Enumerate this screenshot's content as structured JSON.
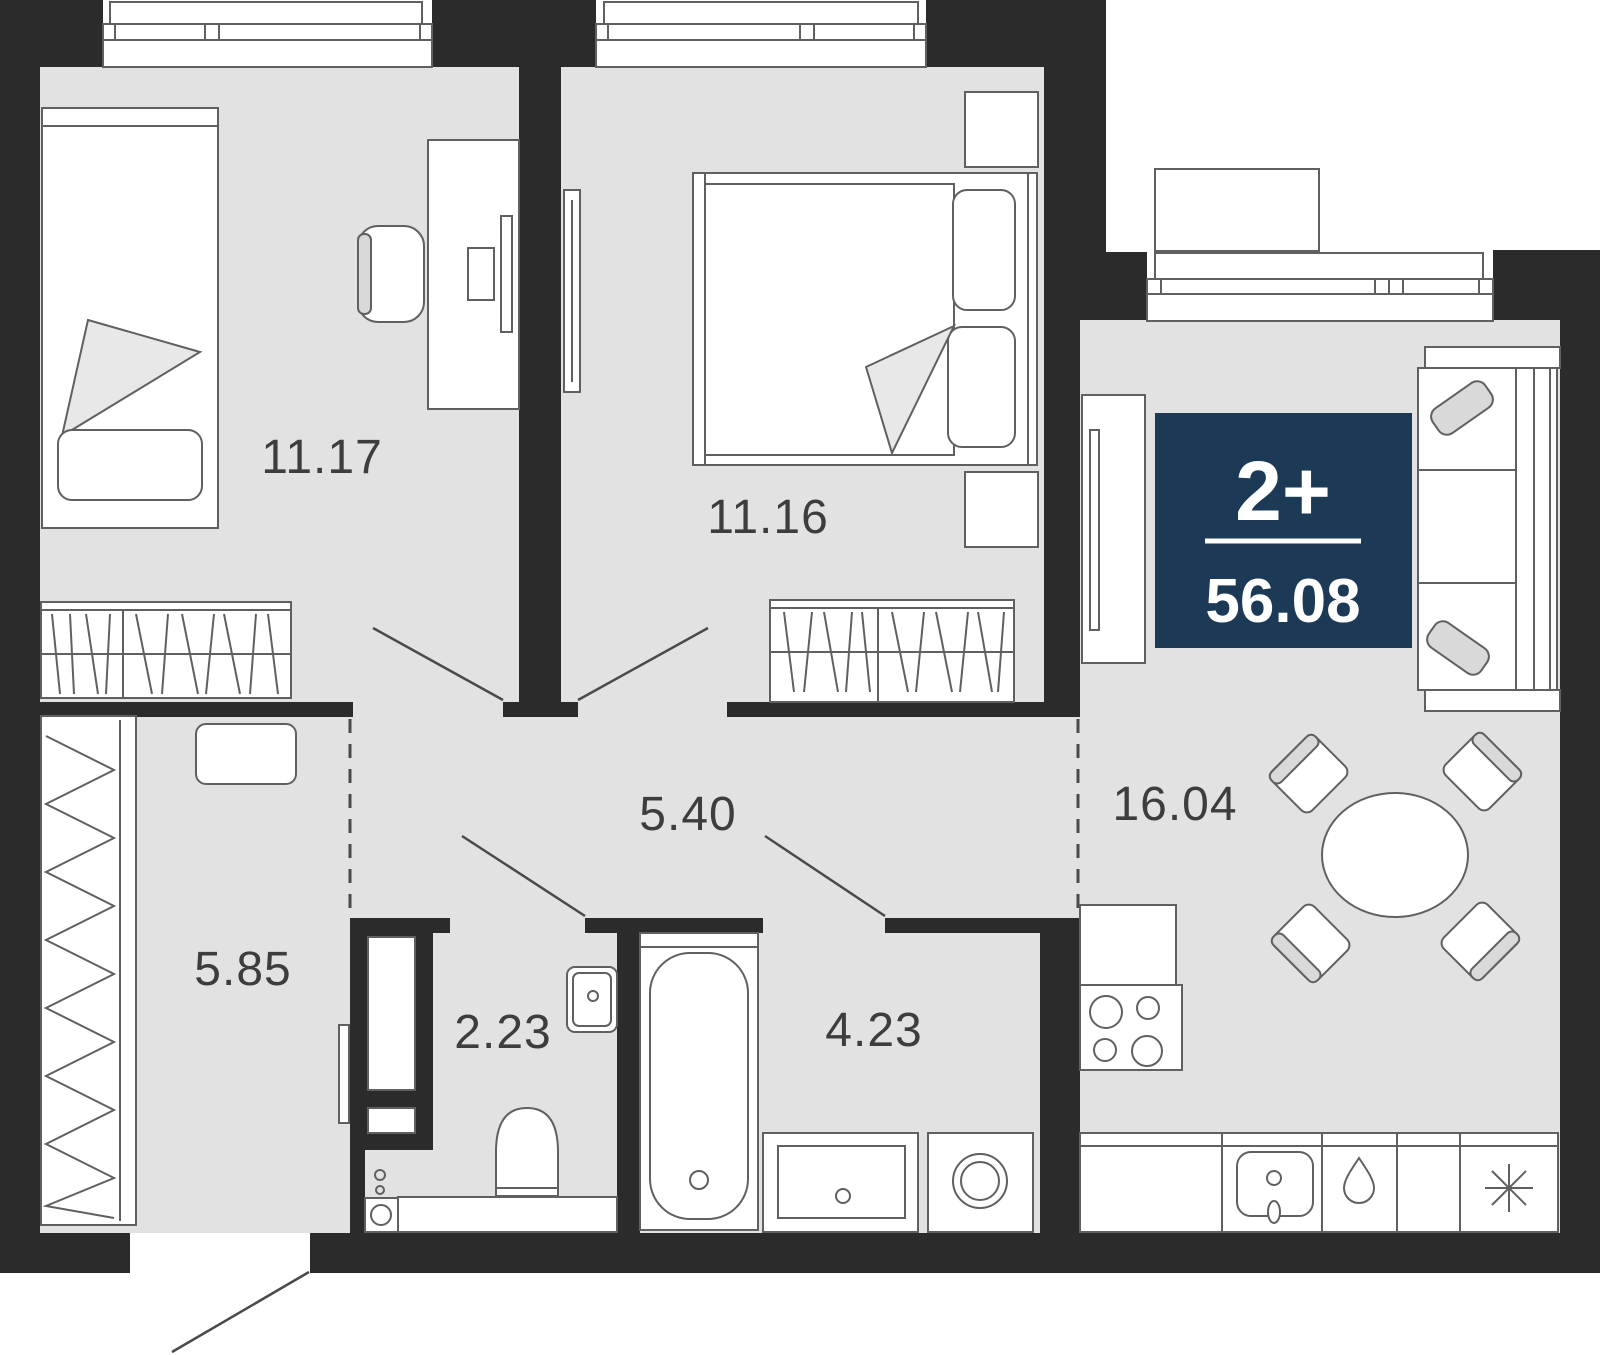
{
  "plan": {
    "type_label": "2+",
    "total_area": "56.08",
    "rooms": [
      {
        "name": "bedroom-1",
        "area": "11.17"
      },
      {
        "name": "bedroom-2",
        "area": "11.16"
      },
      {
        "name": "corridor",
        "area": "5.40"
      },
      {
        "name": "kitchen-living-room",
        "area": "16.04"
      },
      {
        "name": "entry-hall",
        "area": "5.85"
      },
      {
        "name": "toilet",
        "area": "2.23"
      },
      {
        "name": "bathroom",
        "area": "4.23"
      }
    ],
    "badge": {
      "rooms_label": "2+",
      "area_label": "56.08"
    },
    "colors": {
      "wall": "#2b2b2b",
      "floor": "#e2e2e2",
      "outline": "#5f6062",
      "badge_background": "#1c3956",
      "badge_text": "#ffffff",
      "soft_fill": "#d9d9d9"
    },
    "icons": {
      "fridge": "snowflake-icon",
      "water_supply": "water-drop-icon"
    }
  }
}
